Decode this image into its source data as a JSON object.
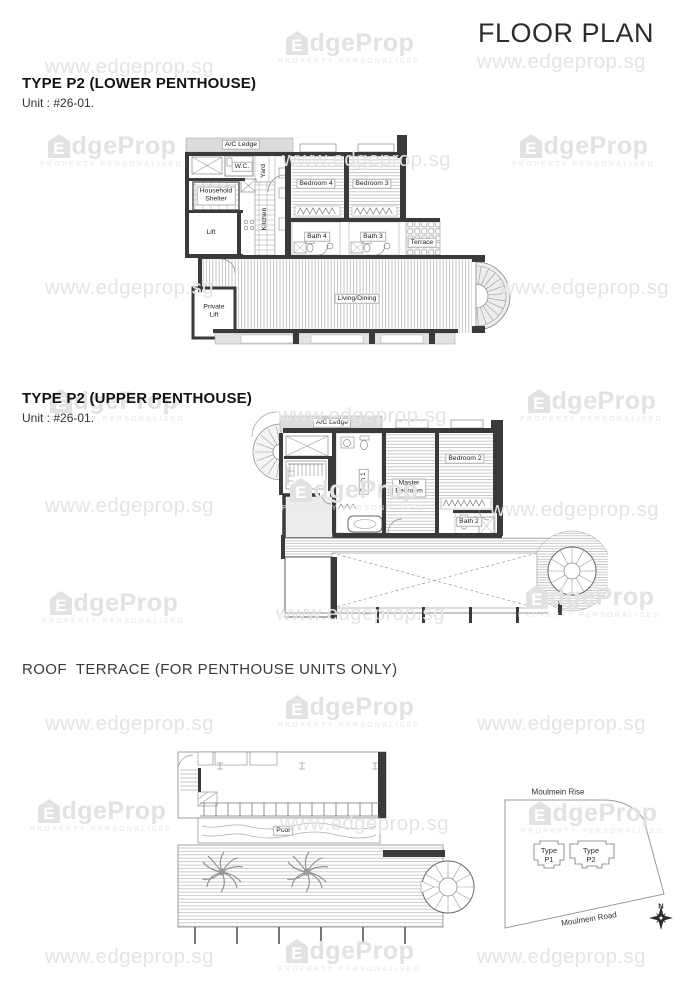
{
  "header": {
    "title": "FLOOR PLAN"
  },
  "watermark": {
    "url": "www.edgeprop.sg",
    "brand_e": "E",
    "brand_rest": "dgeProp",
    "tagline": "PROPERTY PERSONALISED"
  },
  "sections": {
    "lower": {
      "heading": "TYPE P2 (LOWER PENTHOUSE)",
      "unit": "Unit : #26-01."
    },
    "upper": {
      "heading": "TYPE P2 (UPPER PENTHOUSE)",
      "unit": "Unit : #26-01."
    },
    "roof": {
      "heading": "ROOF  TERRACE (FOR PENTHOUSE UNITS ONLY)"
    }
  },
  "plan_lower": {
    "ac_ledge": "A/C Ledge",
    "wc": "W.C.",
    "yard": "Yard",
    "household_shelter": "Household\nShelter",
    "kitchen": "Kitchen",
    "lift": "Lift",
    "bedroom4": "Bedroom 4",
    "bedroom3": "Bedroom 3",
    "bath4": "Bath 4",
    "bath3": "Bath 3",
    "terrace": "Terrace",
    "living_dining": "Living/Dining",
    "private_lift": "Private\nLift"
  },
  "plan_upper": {
    "ac_ledge": "A/C Ledge",
    "bath1": "Bath 1",
    "master_bedroom": "Master\nBedroom",
    "bedroom2": "Bedroom 2",
    "bath2": "Bath 2"
  },
  "plan_roof": {
    "pool": "Pool"
  },
  "site_map": {
    "road_top": "Moulmein Rise",
    "road_bottom": "Moulmein Road",
    "type_p1": "Type\nP1",
    "type_p2": "Type\nP2",
    "north": "N"
  },
  "colors": {
    "wall": "#3a3a3a",
    "watermark": "#e4e4e4",
    "heading": "#121212"
  }
}
